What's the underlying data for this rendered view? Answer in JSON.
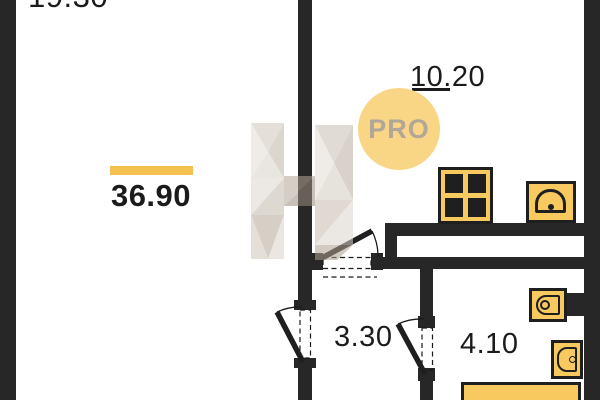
{
  "floor_plan": {
    "watermark_badge": "PRO",
    "total": {
      "area": "36.90"
    },
    "rooms": {
      "living": {
        "area": "19.30"
      },
      "kitchen": {
        "area": "10.20"
      },
      "hallway": {
        "area": "3.30"
      },
      "bathroom": {
        "area": "4.10"
      }
    },
    "colors": {
      "wall": "#272727",
      "fixture_fill": "#F7C95F",
      "accent_bar": "#F2C14E",
      "badge_fill": "#F8D685",
      "badge_text": "#B2A698"
    }
  }
}
